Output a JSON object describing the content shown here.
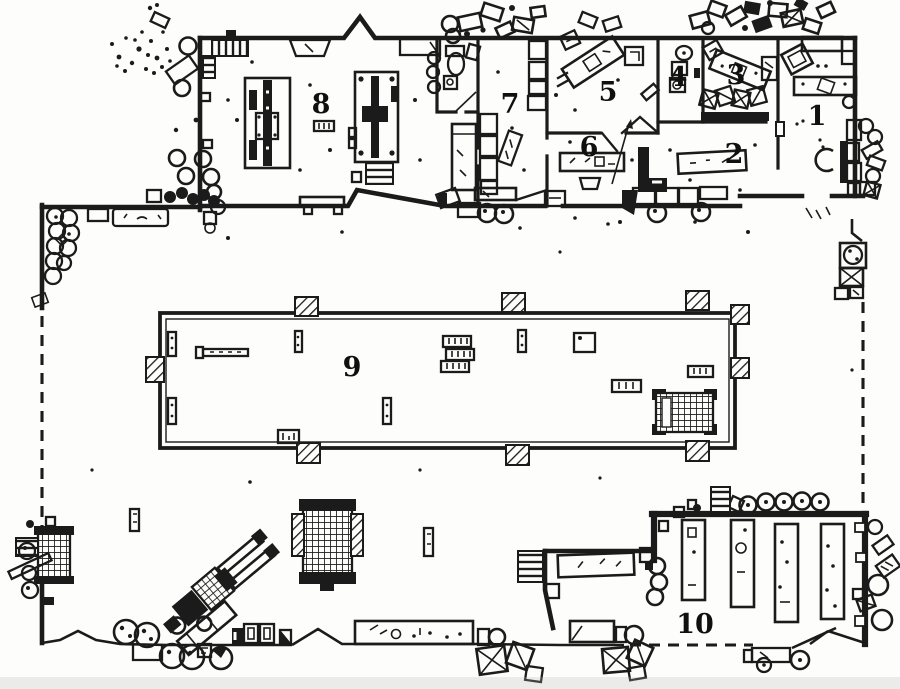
{
  "plan": {
    "paper_color": "#fdfdfb",
    "ink_color": "#1b1b1b",
    "room_labels": [
      {
        "id": "room-1",
        "label": "1"
      },
      {
        "id": "room-2",
        "label": "2"
      },
      {
        "id": "room-3",
        "label": "3"
      },
      {
        "id": "room-4",
        "label": "4"
      },
      {
        "id": "room-5",
        "label": "5"
      },
      {
        "id": "room-6",
        "label": "6"
      },
      {
        "id": "room-7",
        "label": "7"
      },
      {
        "id": "room-8",
        "label": "8"
      },
      {
        "id": "room-9",
        "label": "9"
      },
      {
        "id": "room-10",
        "label": "10"
      }
    ]
  }
}
